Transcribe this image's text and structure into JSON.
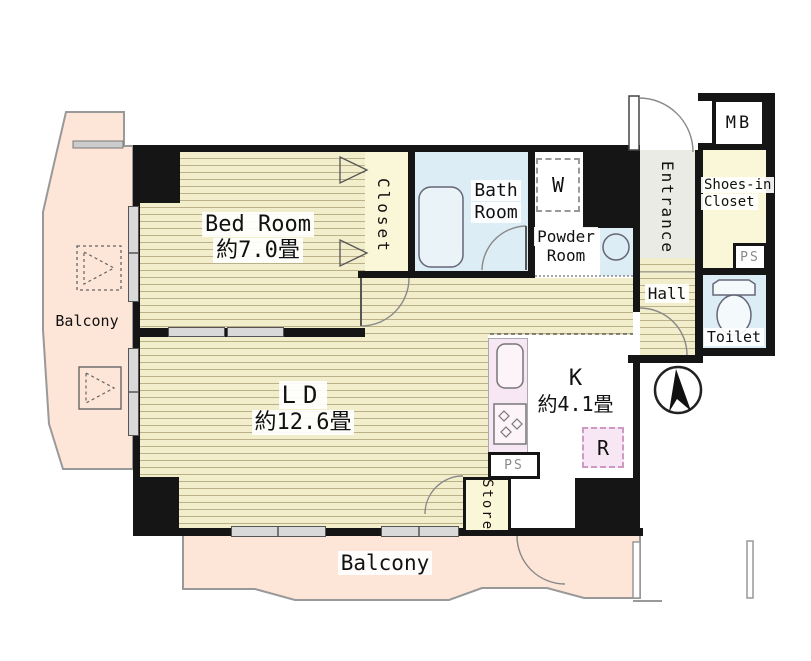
{
  "rooms": {
    "bedroom": {
      "name": "Bed Room",
      "size": "約7.0畳"
    },
    "closet": {
      "name": "Closet"
    },
    "bath": {
      "name": "Bath Room"
    },
    "washer_space": {
      "label": "W"
    },
    "powder": {
      "name": "Powder Room"
    },
    "entrance": {
      "name": "Entrance"
    },
    "meter_box": {
      "label": "MB"
    },
    "shoes_closet": {
      "name": "Shoes-in Closet"
    },
    "pipe_space_upper": {
      "label": "PS"
    },
    "toilet": {
      "name": "Toilet"
    },
    "hall": {
      "name": "Hall"
    },
    "living_dining": {
      "name": "LD",
      "size": "約12.6畳"
    },
    "kitchen": {
      "name": "K",
      "size": "約4.1畳"
    },
    "refrigerator_space": {
      "label": "R"
    },
    "pipe_space_lower": {
      "label": "PS"
    },
    "store": {
      "name": "Store"
    },
    "balcony_left": {
      "name": "Balcony"
    },
    "balcony_bottom": {
      "name": "Balcony"
    }
  },
  "colors": {
    "wall": "#151515",
    "floor": "#f2edcb",
    "floor_line": "#bab189",
    "closet": "#faf6d8",
    "water": "#ddedf5",
    "counter": "#f7e6f3",
    "balcony": "#fde5d7",
    "entrance": "#ebebe6",
    "window": "#d9d9d9",
    "outline": "#999999",
    "gray_text": "#8a8a8a"
  }
}
